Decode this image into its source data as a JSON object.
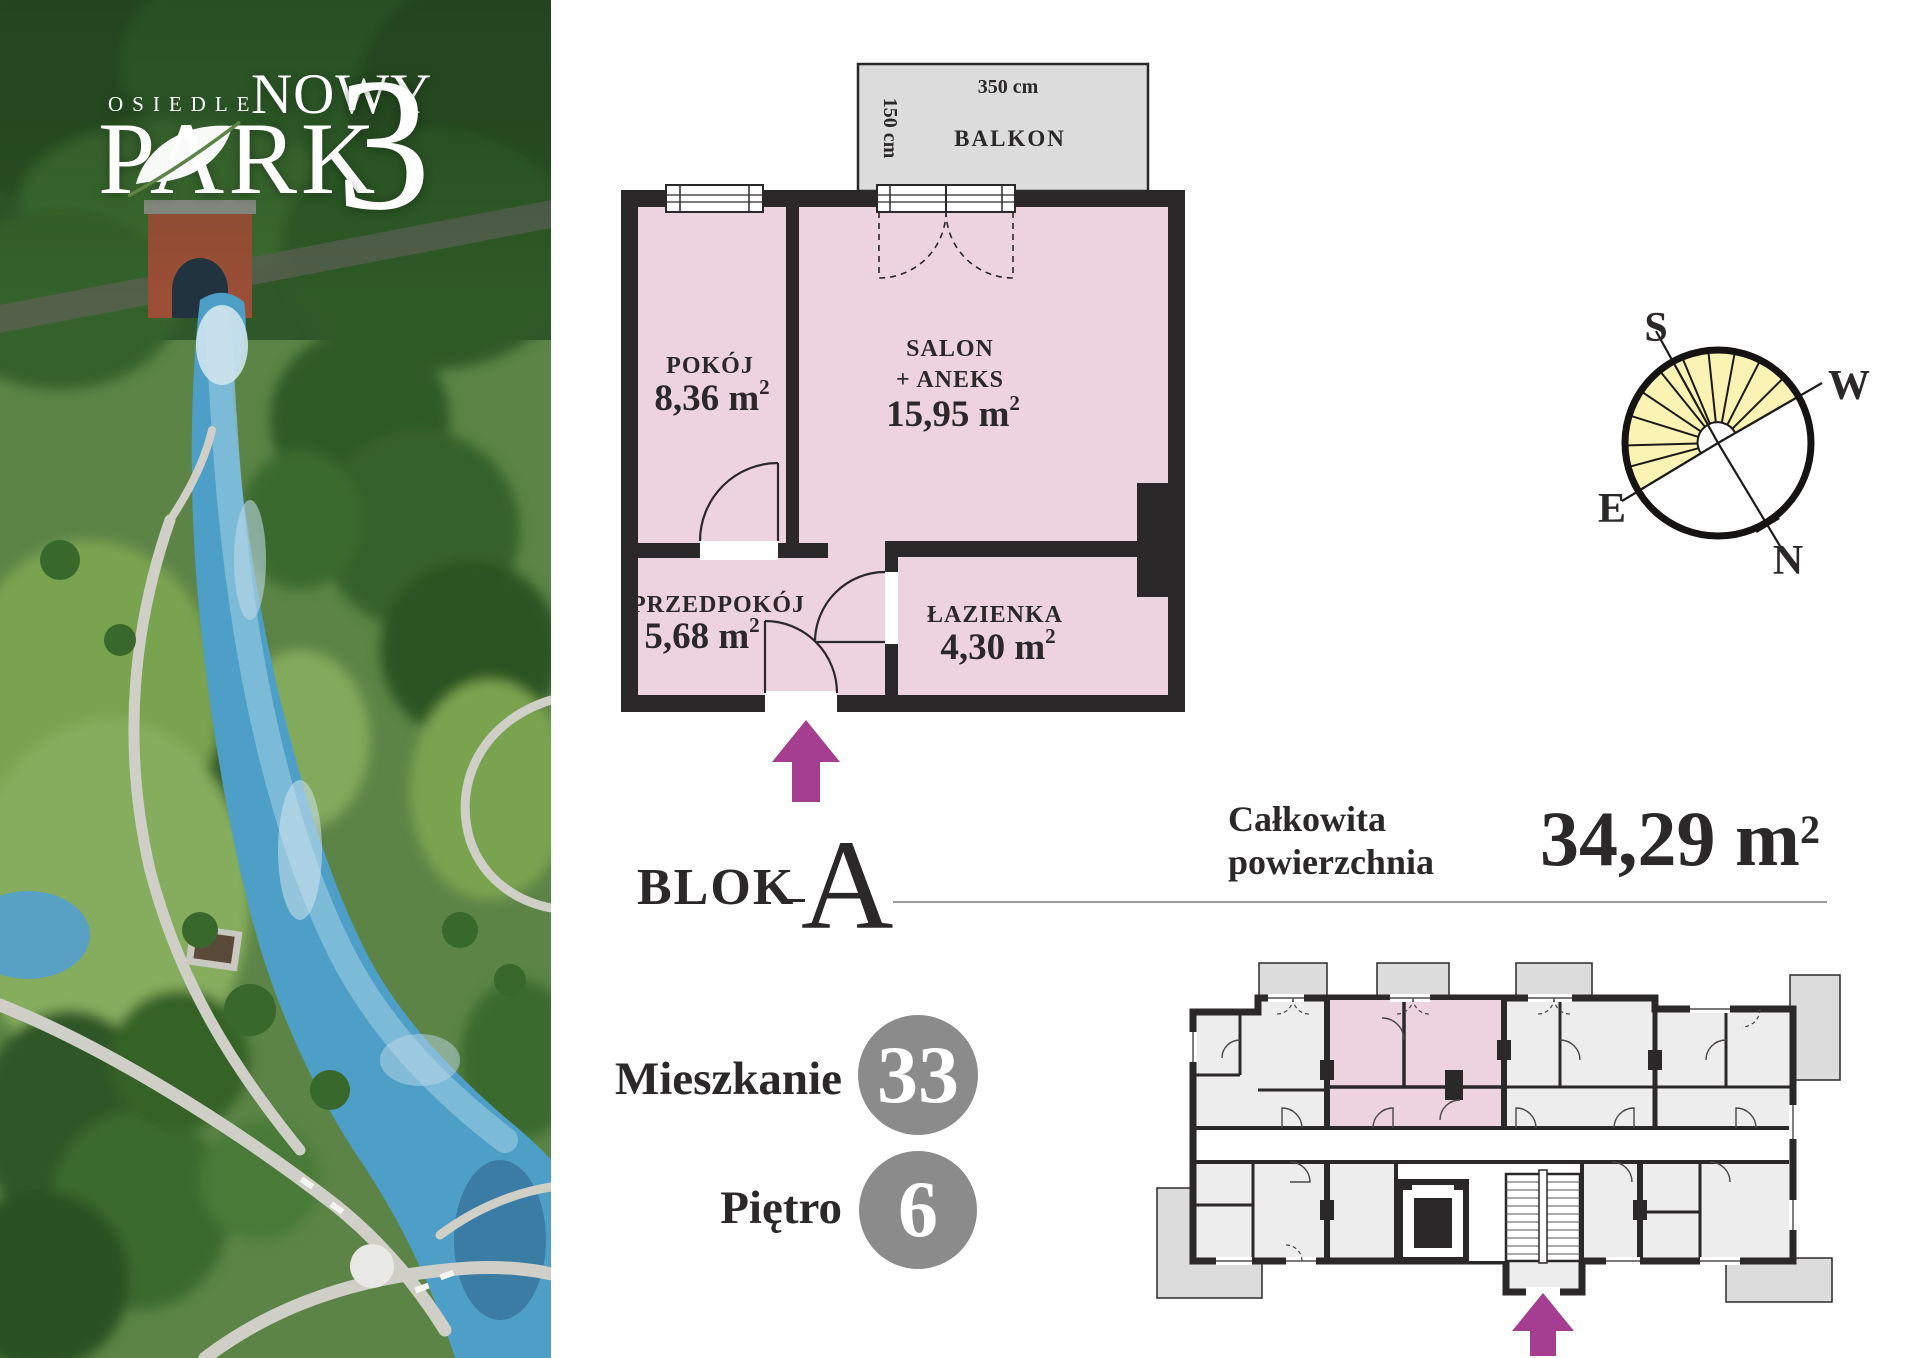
{
  "logo": {
    "line1": "OSIEDLE",
    "line2": "NOWY",
    "line3": "PARK",
    "number": "3"
  },
  "floor_plan": {
    "balcony": {
      "name": "BALKON",
      "width": "350 cm",
      "depth": "150 cm"
    },
    "rooms": {
      "pokoj": {
        "name": "POKÓJ",
        "area": "8,36 m",
        "sup": "2"
      },
      "salon": {
        "name": "SALON",
        "name2": "+ ANEKS",
        "area": "15,95 m",
        "sup": "2"
      },
      "przedpokoj": {
        "name": "PRZEDPOKÓJ",
        "area": "5,68 m",
        "sup": "2"
      },
      "lazienka": {
        "name": "ŁAZIENKA",
        "area": "4,30 m",
        "sup": "2"
      }
    }
  },
  "compass": {
    "south": "S",
    "west": "W",
    "east": "E",
    "north": "N"
  },
  "summary": {
    "block_label": "BLOK",
    "block_value": "A",
    "area_label_line1": "Całkowita",
    "area_label_line2": "powierzchnia",
    "area_value": "34,29 m",
    "area_sup": "2"
  },
  "unit": {
    "apartment_label": "Mieszkanie",
    "apartment_number": "33",
    "floor_label": "Piętro",
    "floor_number": "6"
  },
  "colors": {
    "accent_magenta": "#a53e90",
    "room_pink": "#ecd3df",
    "wall_dark": "#2b2829",
    "balcony_grey": "#dcdcdc",
    "badge_grey": "#8b8b8b",
    "sun_yellow": "#faf3b3"
  }
}
